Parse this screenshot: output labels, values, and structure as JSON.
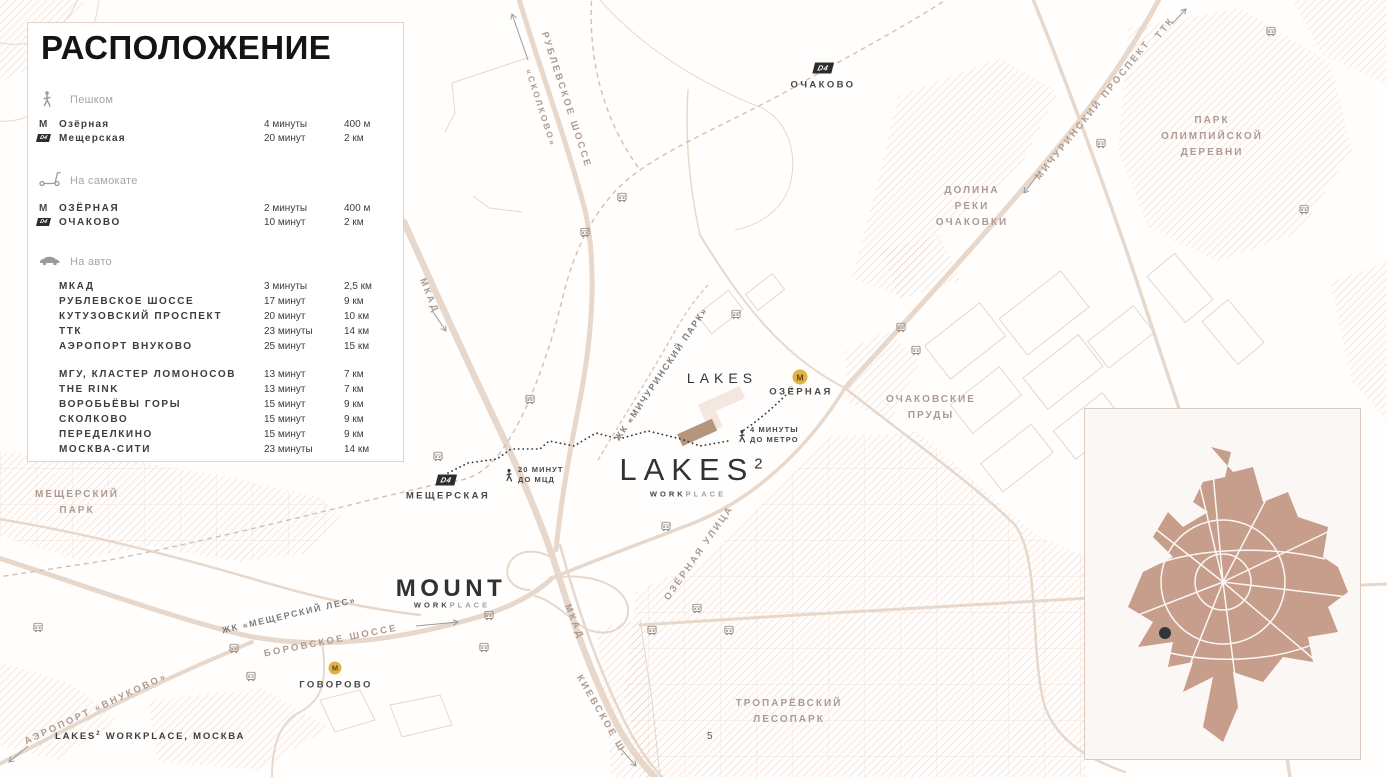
{
  "page": {
    "footer": {
      "brand": "LAKES",
      "sup": "2",
      "rest": " WORKPLACE, МОСКВА"
    },
    "page_number": "5"
  },
  "panel": {
    "title": "РАСПОЛОЖЕНИЕ",
    "sections": [
      {
        "label": "Пешком",
        "rows": [
          {
            "badge": "metro",
            "name": "Озёрная",
            "time": "4 минуты",
            "distance": "400 м"
          },
          {
            "badge": "d4",
            "name": "Мещерская",
            "time": "20 минут",
            "distance": "2 км"
          }
        ]
      },
      {
        "label": "На самокате",
        "rows": [
          {
            "badge": "metro",
            "name": "ОЗЁРНАЯ",
            "time": "2 минуты",
            "distance": "400 м"
          },
          {
            "badge": "d4",
            "name": "ОЧАКОВО",
            "time": "10 минут",
            "distance": "2 км"
          }
        ]
      },
      {
        "label": "На авто",
        "rows": [
          {
            "name": "МКАД",
            "time": "3 минуты",
            "distance": "2,5 км"
          },
          {
            "name": "РУБЛЕВСКОЕ ШОССЕ",
            "time": "17 минут",
            "distance": "9 км"
          },
          {
            "name": "КУТУЗОВСКИЙ ПРОСПЕКТ",
            "time": "20 минут",
            "distance": "10 км"
          },
          {
            "name": "ТТК",
            "time": "23 минуты",
            "distance": "14 км"
          },
          {
            "name": "АЭРОПОРТ ВНУКОВО",
            "time": "25 минут",
            "distance": "15 км"
          }
        ],
        "rows2": [
          {
            "name": "МГУ, КЛАСТЕР ЛОМОНОСОВ",
            "time": "13 минут",
            "distance": "7 км"
          },
          {
            "name": "THE RINK",
            "time": "13 минут",
            "distance": "7 км"
          },
          {
            "name": "ВОРОБЬЁВЫ ГОРЫ",
            "time": "15 минут",
            "distance": "9 км"
          },
          {
            "name": "СКОЛКОВО",
            "time": "15 минут",
            "distance": "9 км"
          },
          {
            "name": "ПЕРЕДЕЛКИНО",
            "time": "15 минут",
            "distance": "9 км"
          },
          {
            "name": "МОСКВА-СИТИ",
            "time": "23 минуты",
            "distance": "14 км"
          }
        ]
      }
    ]
  },
  "icons": {
    "metro_letter": "М",
    "d4_label": "D4"
  },
  "map": {
    "stations": {
      "ochakovo": "ОЧАКОВО",
      "ozernaya": "ОЗЁРНАЯ",
      "meshcherskaya": "МЕЩЕРСКАЯ",
      "govorovo": "ГОВОРОВО"
    },
    "roads": {
      "rublevskoe": "РУБЛЕВСКОЕ ШОССЕ",
      "skolkovo": "«СКОЛКОВО»",
      "michurinsky": "МИЧУРИНСКИЙ ПРОСПЕКТ",
      "ttk": "ТТК",
      "mkad_top": "МКАД",
      "mkad_bottom": "МКАД",
      "borovskoe": "БОРОВСКОЕ ШОССЕ",
      "kievskoe": "КИЕВСКОЕ Ш.",
      "ozernaya_street": "ОЗЁРНАЯ УЛИЦА",
      "vnukovo": "АЭРОПОРТ «ВНУКОВО»"
    },
    "areas": {
      "olympic": [
        "ПАРК",
        "ОЛИМПИЙСКОЙ",
        "ДЕРЕВНИ"
      ],
      "dolina": [
        "ДОЛИНА",
        "РЕКИ",
        "ОЧАКОВКИ"
      ],
      "prudy": [
        "ОЧАКОВСКИЕ",
        "ПРУДЫ"
      ],
      "meshchersky_park": [
        "МЕЩЕРСКИЙ",
        "ПАРК"
      ],
      "troparevsky": [
        "ТРОПАРЁВСКИЙ",
        "ЛЕСОПАРК"
      ]
    },
    "complexes": {
      "zhk_michurinsky": "ЖК «МИЧУРИНСКИЙ ПАРК»",
      "zhk_meshchersky": "ЖК «МЕЩЕРСКИЙ ЛЕС»",
      "lakes_residential": "LAKES",
      "lakes2": {
        "name": "LAKES",
        "sup": "2",
        "sub_dark": "WORK",
        "sub_light": "PLACE"
      },
      "mount": {
        "name": "MOUNT",
        "sub_dark": "WORK",
        "sub_light": "PLACE"
      }
    },
    "notes": {
      "to_metro": [
        "4 МИНУТЫ",
        "ДО МЕТРО"
      ],
      "to_mcd": [
        "20 МИНУТ",
        "ДО МЦД"
      ]
    }
  },
  "colors": {
    "metro_line": "#e2b243",
    "d4_badge": "#2d2d2d",
    "inset_city": "#c79e8b",
    "building_highlight": "#b4967f",
    "hatch": "#d9b6a3"
  }
}
